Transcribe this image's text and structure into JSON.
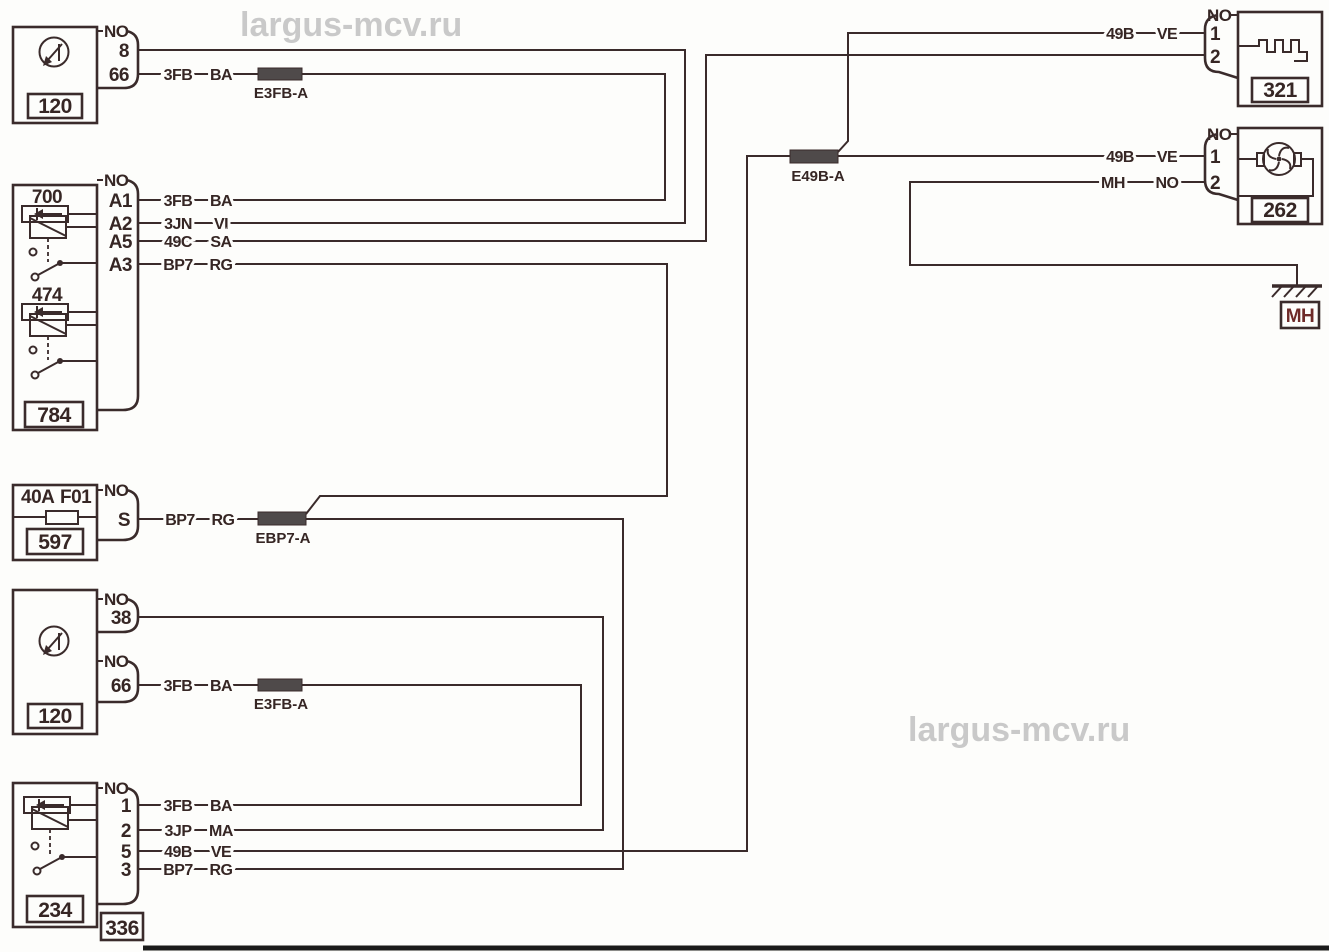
{
  "colors": {
    "line": "#3a2b2b",
    "connector_block": "#4f4a4a",
    "watermark": "#c9c9c9",
    "ground_label": "#6e2a28",
    "background": "#fdfdfb"
  },
  "watermark": {
    "top": "largus-mcv.ru",
    "mid": "largus-mcv.ru"
  },
  "c120_top": {
    "no": "NO",
    "pin8": "8",
    "pin66": "66",
    "id": "120",
    "wire66": {
      "code": "3FB",
      "color": "BA"
    },
    "splice": "E3FB-A"
  },
  "c784": {
    "no": "NO",
    "sub700": "700",
    "sub474": "474",
    "id": "784",
    "pins": {
      "a1": "A1",
      "a2": "A2",
      "a5": "A5",
      "a3": "A3"
    },
    "wires": {
      "a1": {
        "code": "3FB",
        "color": "BA"
      },
      "a2": {
        "code": "3JN",
        "color": "VI"
      },
      "a5": {
        "code": "49C",
        "color": "SA"
      },
      "a3": {
        "code": "BP7",
        "color": "RG"
      }
    }
  },
  "c597": {
    "rating": "40A",
    "fuse_name": "F01",
    "no": "NO",
    "pinS": "S",
    "id": "597",
    "wire": {
      "code": "BP7",
      "color": "RG"
    },
    "splice": "EBP7-A"
  },
  "c120_bot": {
    "no1": "NO",
    "pin38": "38",
    "no2": "NO",
    "pin66": "66",
    "id": "120",
    "wire66": {
      "code": "3FB",
      "color": "BA"
    },
    "splice": "E3FB-A"
  },
  "c234": {
    "no": "NO",
    "id": "234",
    "conn_id": "336",
    "pins": {
      "p1": "1",
      "p2": "2",
      "p5": "5",
      "p3": "3"
    },
    "wires": {
      "p1": {
        "code": "3FB",
        "color": "BA"
      },
      "p2": {
        "code": "3JP",
        "color": "MA"
      },
      "p5": {
        "code": "49B",
        "color": "VE"
      },
      "p3": {
        "code": "BP7",
        "color": "RG"
      }
    }
  },
  "c321": {
    "no": "NO",
    "pin1": "1",
    "pin2": "2",
    "id": "321",
    "wire1": {
      "code": "49B",
      "color": "VE"
    }
  },
  "c262": {
    "no": "NO",
    "pin1": "1",
    "pin2": "2",
    "id": "262",
    "wire1": {
      "code": "49B",
      "color": "VE"
    },
    "wire2": {
      "code": "MH",
      "color": "NO"
    }
  },
  "splice_49b": "E49B-A",
  "ground": {
    "label": "MH"
  }
}
